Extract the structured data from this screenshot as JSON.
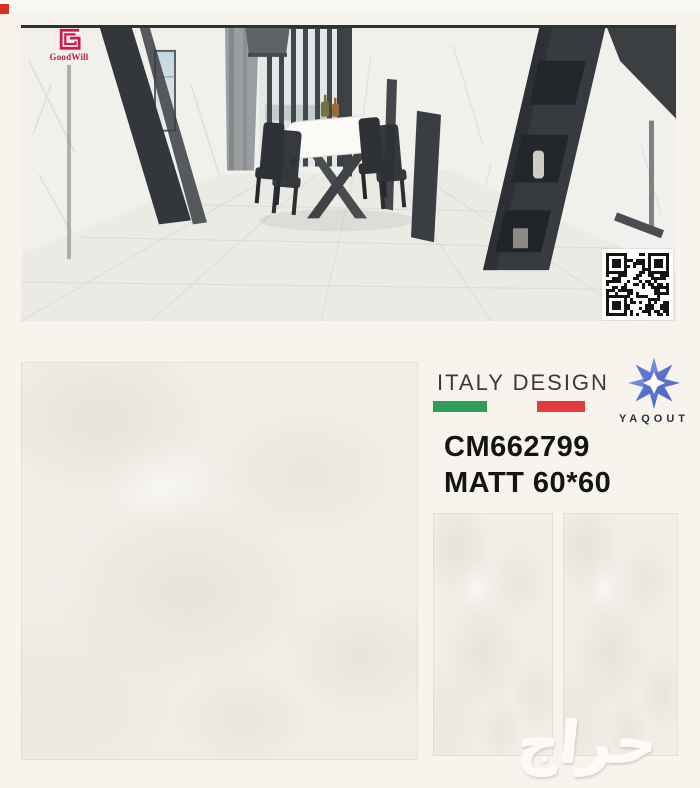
{
  "page": {
    "background": "#f7f4ee",
    "watermark": "حراج"
  },
  "hero": {
    "goodwill_label": "GoodWill",
    "goodwill_color": "#d2174a"
  },
  "branding": {
    "design_label": "ITALY DESIGN",
    "flag_green": "#2e9d5c",
    "flag_red": "#e23c3e",
    "brand_name": "YAQOUT",
    "brand_blue_dark": "#3b55be",
    "brand_blue_light": "#8ea6e8"
  },
  "product": {
    "code": "CM662799",
    "finish": "MATT 60*60"
  }
}
